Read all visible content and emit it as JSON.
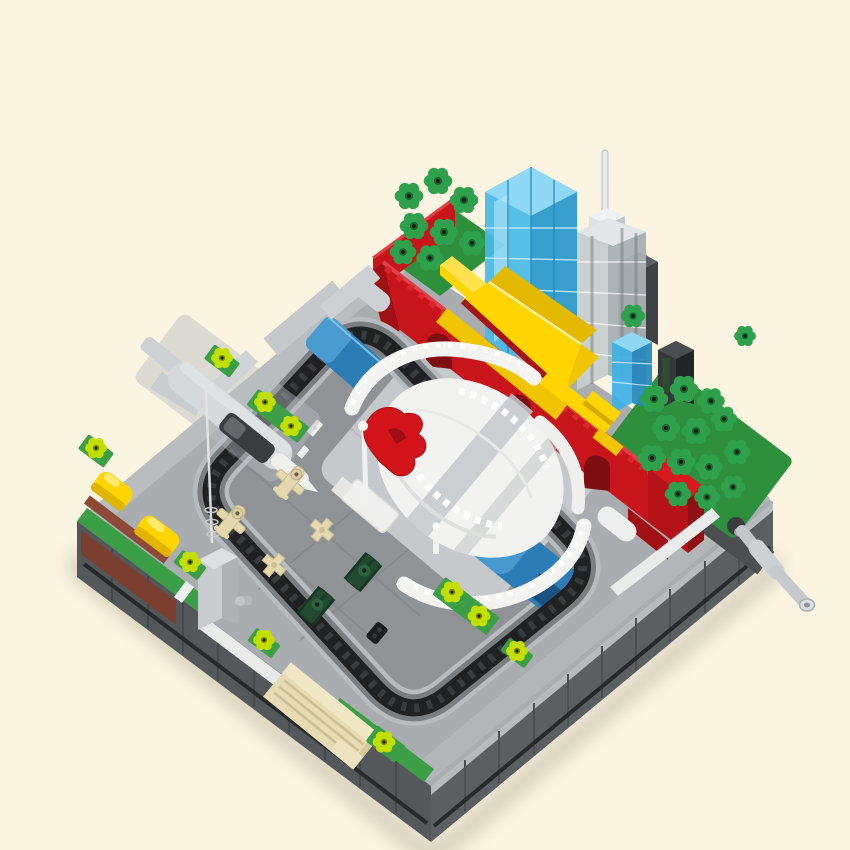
{
  "scene": {
    "alt": "Brick-built micro city-square diorama: red gate wall with yellow roofs, glass skyscrapers, flower-stud trees, white arena with red flag, parade vehicles inside a crank-driven black chain road loop on a gray baseplate"
  },
  "colors": {
    "background": "#FAF4E0",
    "base_top": "#A9ADAF",
    "base_margin": "#B9BDC0",
    "island": "#8F9396",
    "base_side": "#54585B",
    "base_side_se": "#5B5F62",
    "chain": "#1F2123",
    "chain_channel": "#B8BCBF",
    "arena_platform": "#C6C9CB",
    "white_brick": "#F3F3F1",
    "red_wall": "#C8151B",
    "red_wall_dark": "#7E0E12",
    "roof_yellow": "#FFD500",
    "roof_yellow_shade": "#E3B900",
    "flag_red": "#D2131A",
    "tree_green": "#2FA04C",
    "pad_green": "#2E8F3C",
    "plate_green": "#3C9E47",
    "lime": "#C3DF00",
    "water_blue": "#2C7CB5",
    "water_blue_light": "#4E9FD3",
    "tower_blue": "#49B8E8",
    "tower_blue_side": "#2696CC",
    "tower_clear": "#C7CCCF",
    "tower_clear_side": "#A9B0B4",
    "tower_dark": "#35383A",
    "tan": "#E4D8AE",
    "tank_green": "#224A31",
    "vehicle_black": "#1B1C1E",
    "gray_plane": "#D6D9DB",
    "canopy": "#3A3D3F",
    "maroon": "#7B3F30",
    "crank_gray": "#C2C6C9"
  }
}
